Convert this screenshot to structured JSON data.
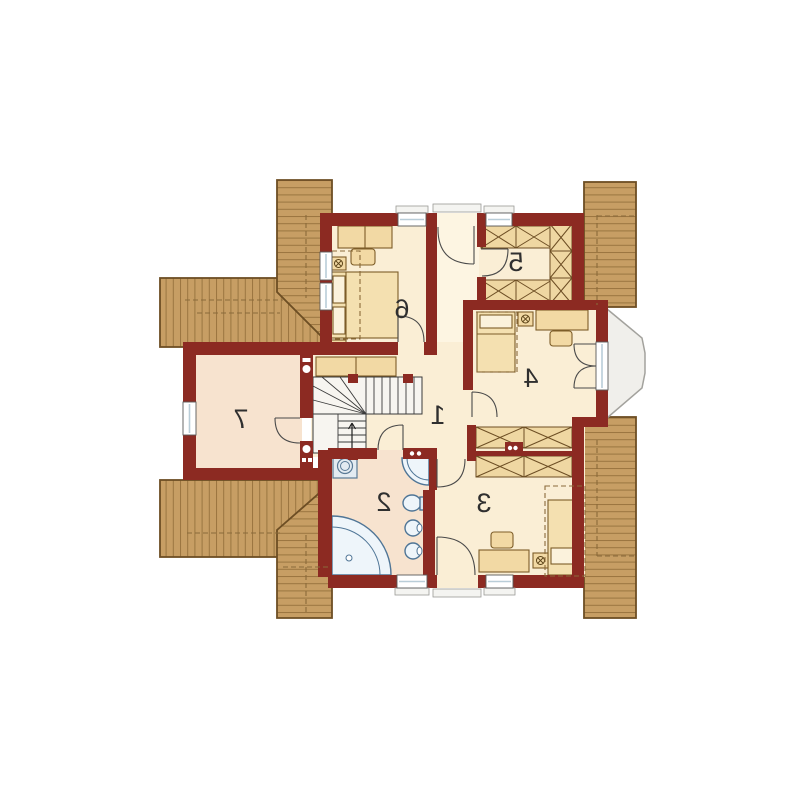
{
  "plan": {
    "type": "floor-plan",
    "mirrored": true,
    "rooms": [
      {
        "label": "1"
      },
      {
        "label": "2"
      },
      {
        "label": "3"
      },
      {
        "label": "4"
      },
      {
        "label": "5"
      },
      {
        "label": "6"
      },
      {
        "label": "7"
      }
    ],
    "icons": [
      "staircase-icon",
      "stair-direction-arrow-icon",
      "corner-bathtub-icon",
      "shower-icon",
      "toilet-icon",
      "sink-icon",
      "washing-machine-icon",
      "double-bed-icon",
      "single-bed-icon",
      "nightstand-lamp-icon",
      "desk-icon",
      "chair-icon",
      "bench-icon",
      "wardrobe-x-icon",
      "door-swing-icon",
      "window-icon",
      "balcony-icon",
      "roof-deck-icon",
      "chimney-vent-icon"
    ],
    "colors": {
      "wall": "#8c2a22",
      "room_floor": "#faeed5",
      "room_floor_alt": "#f7e3cf",
      "corridor_floor": "#fdf5e2",
      "wood_deck": "#c79e64",
      "wood_line": "#9a7540",
      "wood_border": "#6d4e24",
      "furniture": "#f2d9a4",
      "fixture_fill": "#eef5fa",
      "fixture_stroke": "#4f7596",
      "balcony": "#f0efeb",
      "stairs": "#f7f5f0"
    }
  }
}
